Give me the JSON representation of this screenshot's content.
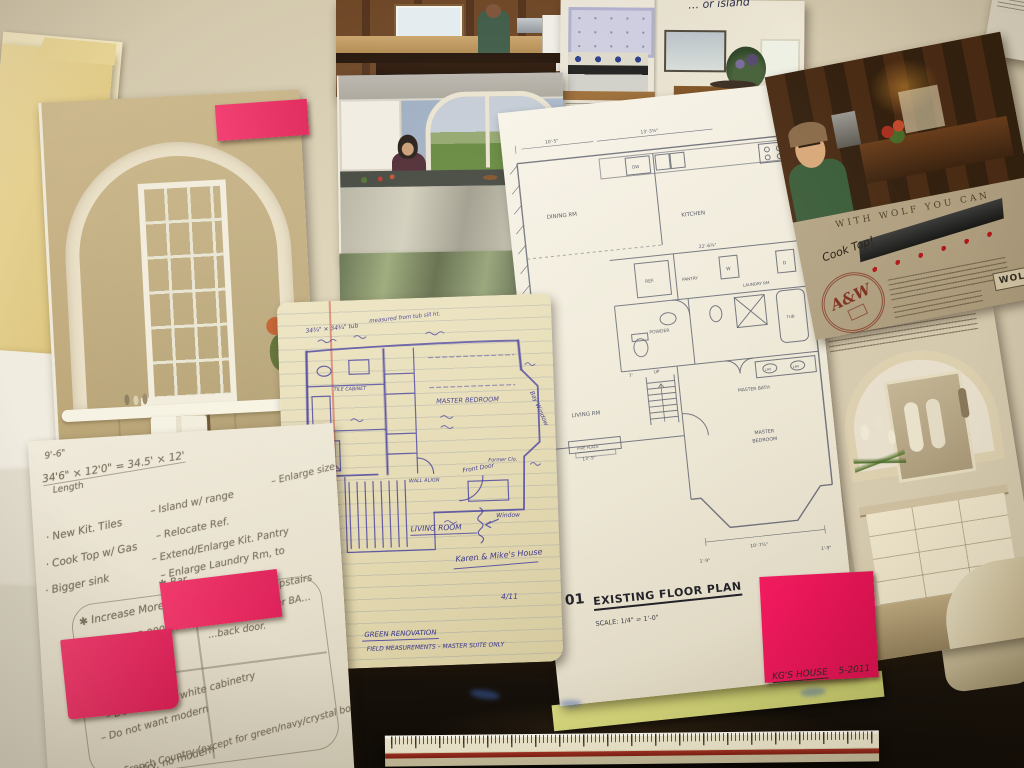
{
  "colors": {
    "wall_beige": "#cfc4a8",
    "sticky_pink": "#ee2e64",
    "sketch_ink": "#38329a",
    "plan_line": "#575b68",
    "pencil_gray": "#7d7361",
    "desk_black": "#17120a",
    "ruler_stripe": "#8e2418",
    "folder_manila": "#e6d496",
    "folder_green_edge": "#b5cf3f"
  },
  "folder": {
    "label": "THE KAREN GREEN RESIDENCE"
  },
  "plan_sheet": {
    "number": "01",
    "title": "EXISTING FLOOR PLAN",
    "scale": "SCALE: 1/4\" = 1'-0\"",
    "corner_note": "KG'S HOUSE",
    "corner_date": "5-2011",
    "rooms": {
      "dining": "DINING RM",
      "kitchen": "KITCHEN",
      "dw": "DW",
      "ref": "REF.",
      "pantry": "PANTRY",
      "washer": "W",
      "laundry": "LAUNDRY RM",
      "dryer": "D",
      "powder": "POWDER",
      "master_bath": "MASTER BATH",
      "living": "LIVING RM",
      "up": "UP",
      "fireplace": "FIRE PLACE",
      "master_bedroom_1": "MASTER",
      "master_bedroom_2": "BEDROOM",
      "lav1": "LAV",
      "lav2": "LAV",
      "tub": "TUB"
    },
    "dims": {
      "left_wall": "11'-8¾\"",
      "dining_top": "10'-5\"",
      "kitchen_top": "13'-3⅜\"",
      "mid": "22'-6¾\"",
      "right": "8'",
      "hall": "7'",
      "living_left": "13'-5\"",
      "bay_bottom": "10'-7¾\"",
      "bay_left": "1'-9\"",
      "bay_right": "1'-9\""
    }
  },
  "sketch": {
    "top_note1": "34¾\" × 34¾\" tub",
    "top_note2": "measured from tub sill ht.",
    "labels": {
      "tile_cabinet": "TILE CABINET",
      "master_bedroom": "MASTER BEDROOM",
      "bay_window": "Bay Window",
      "wall_align": "WALL ALIGN",
      "former_clo": "Former Clo.",
      "front_door": "Front Door",
      "window": "Window",
      "living_room": "LIVING ROOM"
    },
    "house": "Karen & Mike's House",
    "date": "4/11",
    "title": "GREEN RENOVATION",
    "subtitle": "FIELD MEASUREMENTS – MASTER SUITE ONLY"
  },
  "notes": {
    "calc_small": "9'-6\"",
    "calc": "34'6\" × 12'0\" = 34.5' × 12'",
    "calc_label": "Length",
    "left_list": [
      "· New Kit. Tiles",
      "· Cook Top w/ Gas",
      "· Bigger sink"
    ],
    "mid_list": [
      "– Island w/ range",
      "– Relocate Ref.",
      "– Extend/Enlarge Kit. Pantry",
      "– Enlarge Laundry Rm, to",
      "✱ Bar"
    ],
    "right_fragment": "– Enlarge size of…",
    "starred1": "✱ Move M. Bedroom Upstairs",
    "starred1b": "Increase Master BA…",
    "starred2": "✱ Increase More Kit…",
    "price_line": "1995  $125,000.00",
    "sqft": "2,112 sf.",
    "back_door": "…back door.",
    "dislikes": [
      "– Does not like white cabinetry",
      "– Do not want modern",
      "– No French Country (except for green/navy/crystal bowl)",
      "– No country, no modern",
      "– … a dark!"
    ]
  },
  "wolf_ad": {
    "headline": "WITH WOLF YOU CAN",
    "handwritten": "Cook Top!",
    "stamp": "A&W",
    "logo": "WOLF"
  },
  "kitchen_spread": {
    "annotation": "… or island"
  }
}
